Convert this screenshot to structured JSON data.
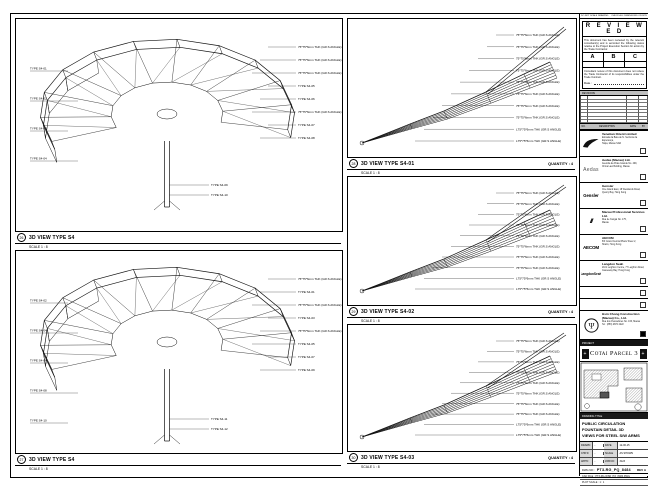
{
  "sheet": {
    "top_note_left": "DO NOT SCALE DRAWING",
    "top_note_right": "CHECK ALL DIMENSIONS ON SITE"
  },
  "views": {
    "v1": {
      "num": "26",
      "title": "3D VIEW TYPE S4",
      "scale": "SCALE 1 : 8",
      "quantity": "",
      "left": [
        "TYPE S4-01",
        "TYPE S4-02",
        "TYPE S4-03",
        "TYPE S4-04"
      ],
      "right": [
        "75*75*6mm THK (GR.S ANGLE)",
        "75*75*6mm THK (GR.S ANGLE)",
        "75*75*6mm THK (GR.S ANGLE)",
        "TYPE S4-05",
        "TYPE S4-06",
        "75*75*6mm THK (GR.S ANGLE)",
        "TYPE S4-07",
        "TYPE S4-08"
      ],
      "bottom": [
        "TYPE S4-09",
        "TYPE S4-10"
      ]
    },
    "v2": {
      "num": "27",
      "title": "3D VIEW TYPE S4",
      "scale": "SCALE 1 : 8",
      "quantity": "",
      "left": [
        "TYPE S4-02",
        "TYPE S4-04",
        "TYPE S4-06",
        "TYPE S4-08",
        "TYPE S4-10"
      ],
      "right": [
        "75*75*6mm THK (GR.S ANGLE)",
        "TYPE S4-01",
        "75*75*6mm THK (GR.S ANGLE)",
        "TYPE S4-03",
        "75*75*6mm THK (GR.S ANGLE)",
        "TYPE S4-05",
        "TYPE S4-07",
        "TYPE S4-09"
      ],
      "bottom": [
        "TYPE S4-11",
        "TYPE S4-12"
      ]
    },
    "v3": {
      "num": "28",
      "title": "3D VIEW TYPE S4-01",
      "scale": "SCALE 1 : 8",
      "quantity": "QUANTITY : 4",
      "labels": [
        "75*75*6mm THK (GR.S ANGLE)",
        "75*75*6mm THK (GR.S ANGLE)",
        "75*75*6mm THK (GR.S ANGLE)",
        "75*75*6mm THK (GR.S ANGLE)",
        "75*75*6mm THK (GR.S ANGLE)",
        "75*75*6mm THK (GR.S ANGLE)",
        "75*75*6mm THK (GR.S ANGLE)",
        "75*75*6mm THK (GR.S ANGLE)",
        "L75*75*6mm THK (GR.S ANGLE)",
        "L75*75*6mm THK (GR.S ANGLE)"
      ]
    },
    "v4": {
      "num": "29",
      "title": "3D VIEW TYPE S4-02",
      "scale": "SCALE 1 : 8",
      "quantity": "QUANTITY : 4",
      "labels": [
        "75*75*6mm THK (GR.S ANGLE)",
        "75*75*6mm THK (GR.S ANGLE)",
        "75*75*6mm THK (GR.S ANGLE)",
        "75*75*6mm THK (GR.S ANGLE)",
        "75*75*6mm THK (GR.S ANGLE)",
        "75*75*6mm THK (GR.S ANGLE)",
        "75*75*6mm THK (GR.S ANGLE)",
        "75*75*6mm THK (GR.S ANGLE)",
        "L75*75*6mm THK (GR.S ANGLE)",
        "L75*75*6mm THK (GR.S ANGLE)"
      ]
    },
    "v5": {
      "num": "30",
      "title": "3D VIEW TYPE S4-03",
      "scale": "SCALE 1 : 8",
      "quantity": "QUANTITY : 4",
      "labels": [
        "75*75*6mm THK (GR.S ANGLE)",
        "75*75*6mm THK (GR.S ANGLE)",
        "75*75*6mm THK (GR.S ANGLE)",
        "75*75*6mm THK (GR.S ANGLE)",
        "75*75*6mm THK (GR.S ANGLE)",
        "75*75*6mm THK (GR.S ANGLE)",
        "75*75*6mm THK (GR.S ANGLE)",
        "75*75*6mm THK (GR.S ANGLE)",
        "L75*75*6mm THK (GR.S ANGLE)",
        "L75*75*6mm THK (GR.S ANGLE)"
      ]
    }
  },
  "titleblock": {
    "stamp": {
      "title": "R E V I E W E D",
      "body": "This document has been reviewed by the relevant consultant(s) and is accorded the following status relative to the Project Execution Section for action by the Trade Contractor.",
      "columns": [
        "A",
        "B",
        "C"
      ],
      "note": "Consultant review of this document does not relieve the Trade Contractor of its responsibilities under the Trade Contract.",
      "date_label": "Date :"
    },
    "revisions": {
      "title": "REVISIONS",
      "header": [
        "NO.",
        "DESCRIPTION",
        "DATE",
        "BY"
      ]
    },
    "companies": [
      {
        "logo_text": "",
        "name": "Venetian Orient Limited",
        "lines": [
          "Estrada da Baía de N. Senhora da Esperança,",
          "Taipa, Macau SAR"
        ]
      },
      {
        "logo_text": "Aedas",
        "name": "Aedas (Macau) Ltd.",
        "lines": [
          "Avenida da Praia Grande No. 409,",
          "China Law Building, Macau"
        ]
      },
      {
        "logo_text": "Gensler",
        "name": "Gensler",
        "lines": [
          "One Island East, 18 Westlands Road,",
          "Quarry Bay, Hong Kong"
        ]
      },
      {
        "logo_text": "///",
        "name": "Macau Professional Services Ltd.",
        "lines": [
          "Rua de Xangai No. 175,",
          "Macau"
        ]
      },
      {
        "logo_text": "AECOM",
        "name": "AECOM",
        "lines": [
          "8/F Grand Central Plaza Tower 2,",
          "Shatin, Hong Kong"
        ]
      },
      {
        "logo_text": "LangdonSeah",
        "name": "Langdon Seah",
        "lines": [
          "2101 Leighton Centre, 77 Leighton Road,",
          "Causeway Bay, Hong Kong"
        ]
      }
    ],
    "contractor": {
      "name": "Hsin Chong Construction (Macau) Co., Ltd.",
      "lines": [
        "Rua dos Pescadores No. 166, Macau",
        "Tel : (853) 2872 2222"
      ]
    },
    "project_bar": "PROJECT",
    "project_title": "Cotai Parcel 3",
    "drawing_title_bar": "DRAWING TITLE",
    "drawing_title_lines": [
      "PUBLIC CIRCULATION",
      "FOUNTAIN DETAIL 3D",
      "VIEWS FOR STEEL S/W ARMS"
    ],
    "fields_rows": [
      [
        "DRAWN",
        "-",
        "DATE",
        "12-06-15"
      ],
      [
        "CHK'D",
        "-",
        "SCALE",
        "AS SHOWN"
      ],
      [
        "APP'D",
        "-",
        "JOB NO",
        "3123"
      ]
    ],
    "dwg_no_label": "DWG NO :",
    "dwg_no": "PT3-RG_PQ_8484",
    "rev": "REV A",
    "meta": [
      "CAD FILE : PT3-RG-WSD_PQ_8484.DWG",
      "PLOT SCALE : 1 : 1"
    ]
  }
}
